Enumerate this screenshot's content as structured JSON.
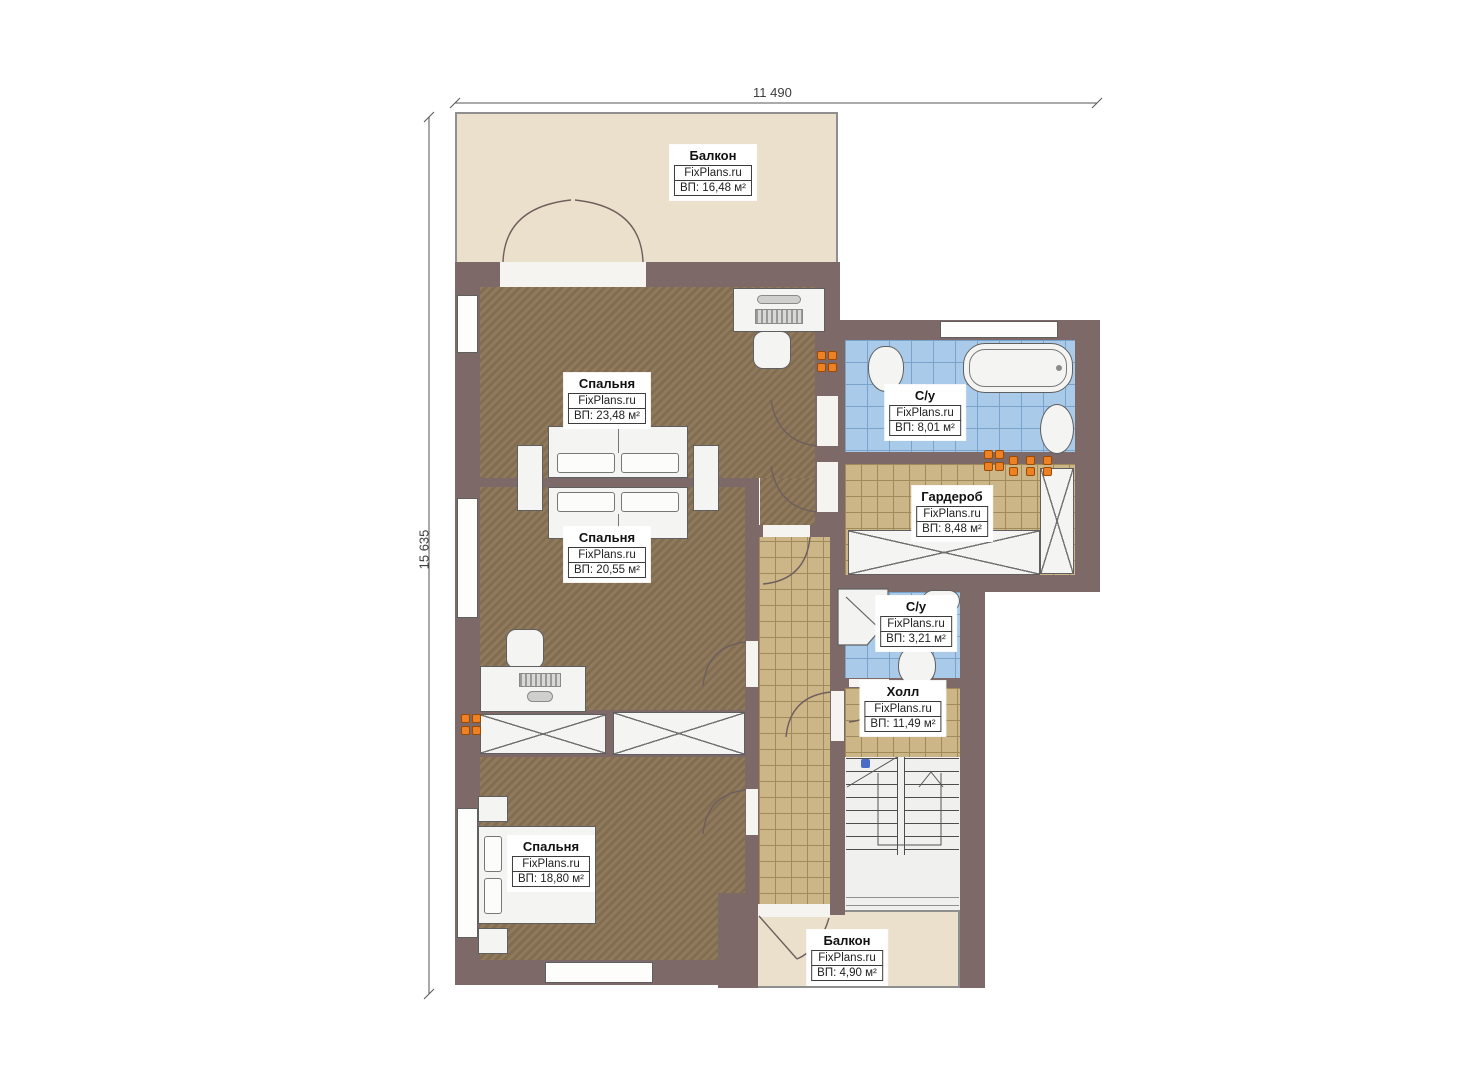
{
  "dimensions": {
    "width": "11 490",
    "height": "15 635"
  },
  "rooms": [
    {
      "id": "balcony-top",
      "name": "Балкон",
      "brand": "FixPlans.ru",
      "area": "ВП: 16,48 м²"
    },
    {
      "id": "bedroom-1",
      "name": "Спальня",
      "brand": "FixPlans.ru",
      "area": "ВП: 23,48 м²"
    },
    {
      "id": "bathroom-1",
      "name": "С/у",
      "brand": "FixPlans.ru",
      "area": "ВП: 8,01 м²"
    },
    {
      "id": "wardrobe",
      "name": "Гардероб",
      "brand": "FixPlans.ru",
      "area": "ВП: 8,48 м²"
    },
    {
      "id": "bedroom-2",
      "name": "Спальня",
      "brand": "FixPlans.ru",
      "area": "ВП: 20,55 м²"
    },
    {
      "id": "bathroom-2",
      "name": "С/у",
      "brand": "FixPlans.ru",
      "area": "ВП: 3,21 м²"
    },
    {
      "id": "hall",
      "name": "Холл",
      "brand": "FixPlans.ru",
      "area": "ВП: 11,49 м²"
    },
    {
      "id": "bedroom-3",
      "name": "Спальня",
      "brand": "FixPlans.ru",
      "area": "ВП: 18,80 м²"
    },
    {
      "id": "balcony-bottom",
      "name": "Балкон",
      "brand": "FixPlans.ru",
      "area": "ВП: 4,90 м²"
    }
  ],
  "colors": {
    "wall": "#7e6969",
    "bedroom_floor": "#8a7355",
    "tile_floor": "#ccb687",
    "tile_line": "#a08a5c",
    "bath_floor": "#a9cbe9",
    "bath_line": "#7aa3cc",
    "balcony_floor": "#eae0cb",
    "stairs_floor": "#f0f0ee",
    "socket": "#ee8124",
    "furniture": "#f4f4f2"
  }
}
